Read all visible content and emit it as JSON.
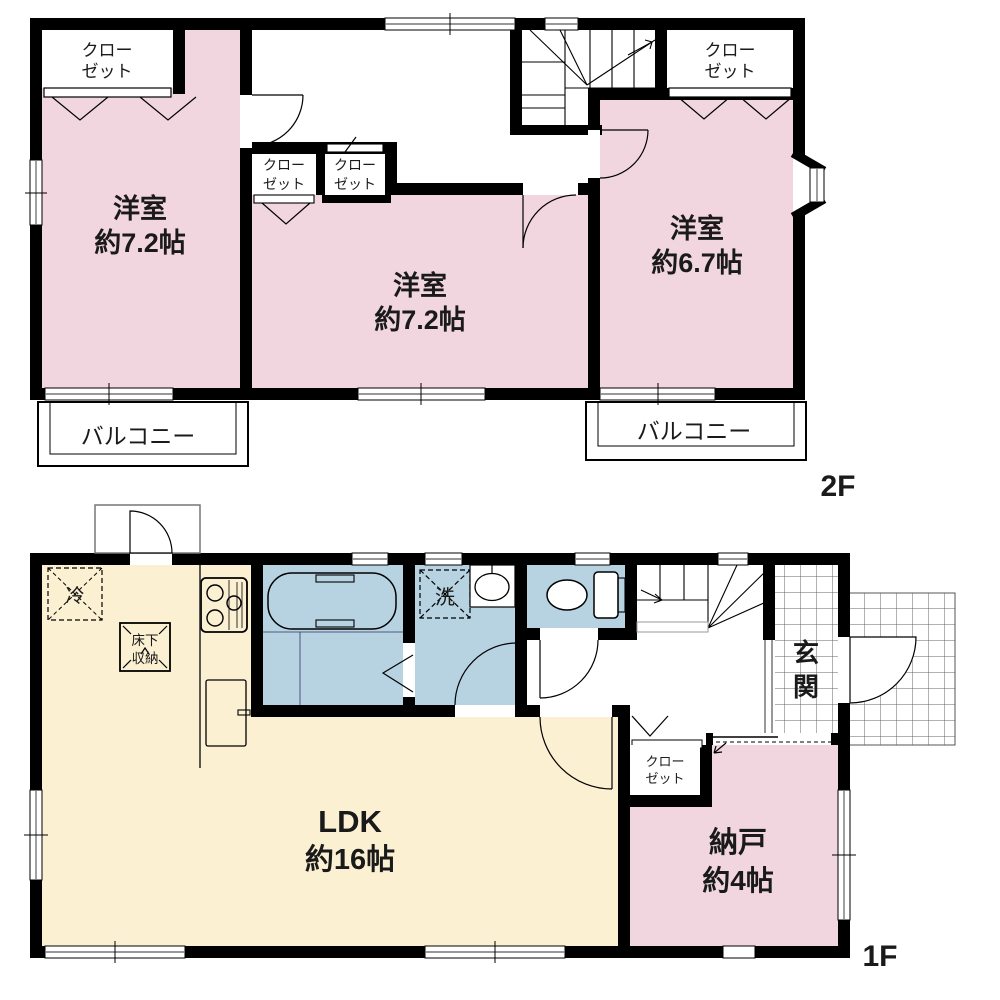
{
  "colors": {
    "room_pink": "#F1D6E0",
    "room_cream": "#FBF0D2",
    "room_blue": "#B7D3E1",
    "wall": "#000000",
    "window_line": "#777777"
  },
  "floor2": {
    "label": "2F",
    "rooms": {
      "left_room": {
        "line1": "洋室",
        "line2": "約7.2帖"
      },
      "middle_room": {
        "line1": "洋室",
        "line2": "約7.2帖"
      },
      "right_room": {
        "line1": "洋室",
        "line2": "約6.7帖"
      },
      "closet_top_left": {
        "line1": "クロー",
        "line2": "ゼット"
      },
      "closet_mid_left": {
        "line1": "クロー",
        "line2": "ゼット"
      },
      "closet_mid_right": {
        "line1": "クロー",
        "line2": "ゼット"
      },
      "closet_top_right": {
        "line1": "クロー",
        "line2": "ゼット"
      },
      "balcony_left": {
        "label": "バルコニー"
      },
      "balcony_right": {
        "label": "バルコニー"
      }
    }
  },
  "floor1": {
    "label": "1F",
    "rooms": {
      "ldk": {
        "line1": "LDK",
        "line2": "約16帖"
      },
      "storage": {
        "line1": "納戸",
        "line2": "約4帖"
      },
      "entrance": {
        "line1": "玄",
        "line2": "関"
      },
      "closet": {
        "line1": "クロー",
        "line2": "ゼット"
      },
      "refrigerator": {
        "label": "冷"
      },
      "underfloor_storage": {
        "line1": "床下",
        "line2": "収納"
      },
      "washing_machine": {
        "label": "洗"
      }
    }
  }
}
